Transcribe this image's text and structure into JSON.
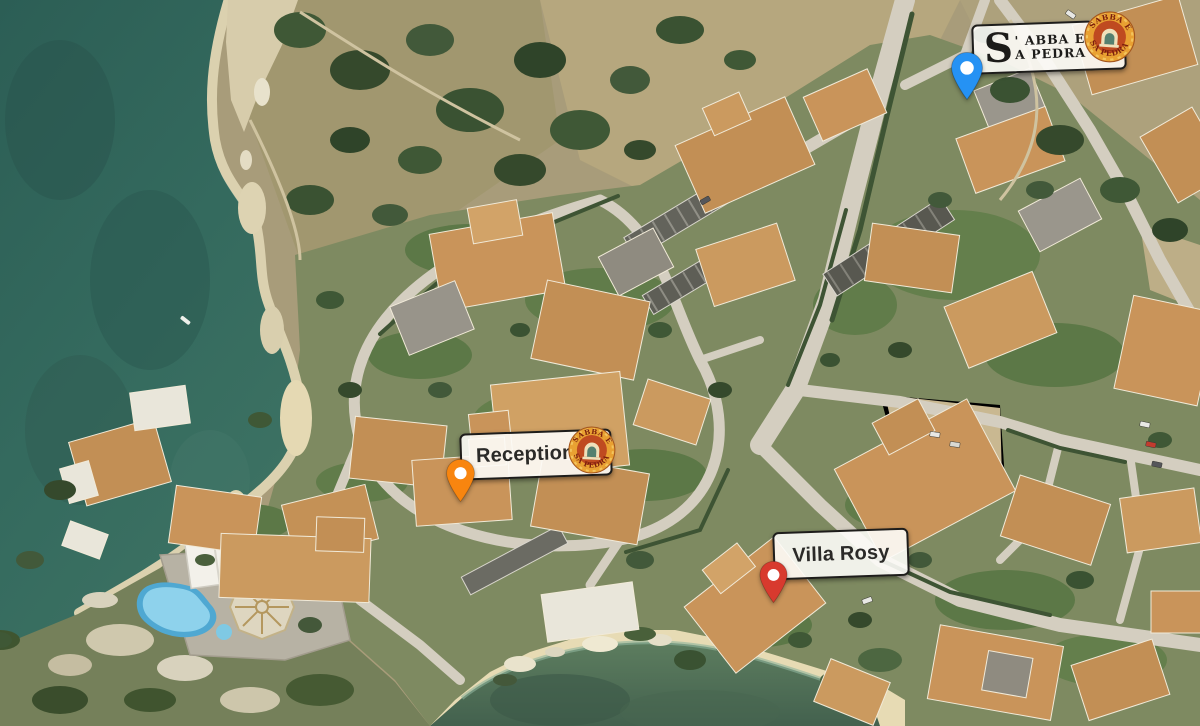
{
  "resort_label": {
    "dropcap": "S",
    "line1": "' ABBA E",
    "line2": "A PEDRA"
  },
  "reception_label": {
    "text": "Reception"
  },
  "villa_label": {
    "text": "Villa Rosy"
  },
  "logo": {
    "arc_top": "SABBA E",
    "arc_bottom": "SA PEDRA"
  },
  "markers": {
    "blue": {
      "color": "#2592f4"
    },
    "orange": {
      "color": "#f8850f"
    },
    "red": {
      "color": "#d83a2e"
    }
  }
}
